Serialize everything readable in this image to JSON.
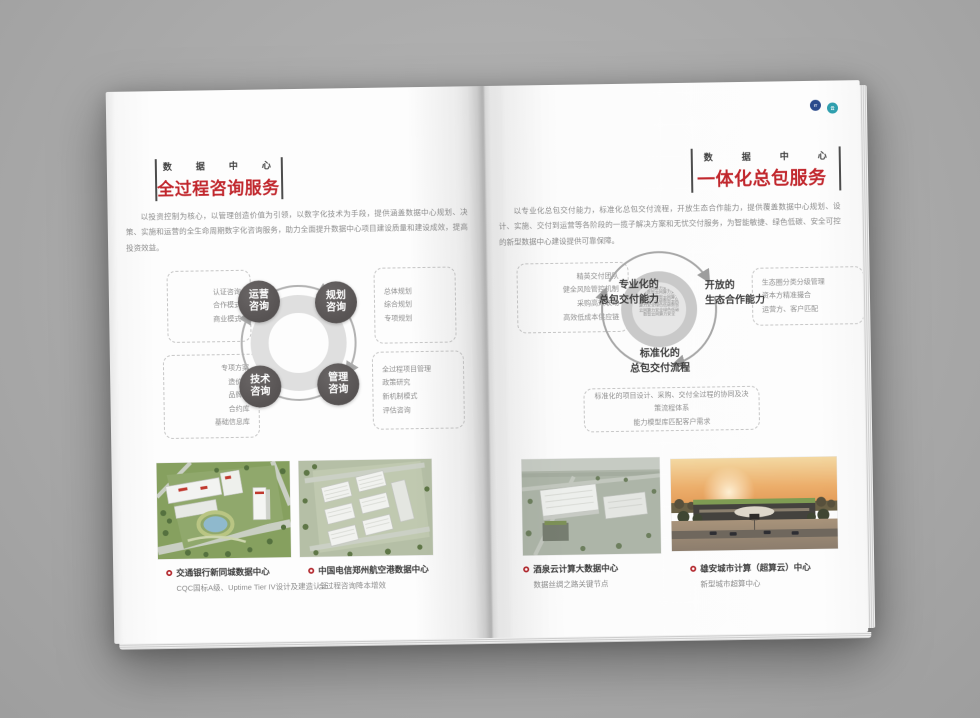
{
  "left_page": {
    "eyebrow": "数据中心",
    "title": "全过程咨询服务",
    "intro": "以投资控制为核心，以管理创造价值为引领，以数字化技术为手段，提供涵盖数据中心规划、决策、实施和运营的全生命周期数字化咨询服务，助力全面提升数据中心项目建设质量和建设成效，提高投资效益。",
    "diagram": {
      "nodes": [
        {
          "line1": "运营",
          "line2": "咨询"
        },
        {
          "line1": "规划",
          "line2": "咨询"
        },
        {
          "line1": "技术",
          "line2": "咨询"
        },
        {
          "line1": "管理",
          "line2": "咨询"
        }
      ],
      "boxes": {
        "top_left": [
          "认证咨询",
          "合作模式",
          "商业模式"
        ],
        "top_right": [
          "总体规划",
          "综合规划",
          "专项规划"
        ],
        "bottom_left": [
          "专项方案",
          "造价库",
          "品牌库",
          "合约库",
          "基础信息库"
        ],
        "bottom_right": [
          "全过程项目管理",
          "政策研究",
          "新机制模式",
          "评估咨询"
        ]
      }
    },
    "cases": [
      {
        "title": "交通银行新同城数据中心",
        "subtitle": "CQC国标A级、Uptime Tier IV设计及建造认证"
      },
      {
        "title": "中国电信郑州航空港数据中心",
        "subtitle": "全过程咨询降本增效"
      }
    ]
  },
  "right_page": {
    "eyebrow": "数据中心",
    "title": "一体化总包服务",
    "intro": "以专业化总包交付能力，标准化总包交付流程，开放生态合作能力，提供覆盖数据中心规划、设计、实施、交付到运营等各阶段的一揽子解决方案和无忧交付服务，为智能敏捷、绿色低碳、安全可控的新型数据中心建设提供可靠保障。",
    "diagram": {
      "labels": {
        "professional": {
          "line1": "专业化的",
          "line2": "总包交付能力"
        },
        "open": {
          "line1": "开放的",
          "line2": "生态合作能力"
        },
        "standard": {
          "line1": "标准化的",
          "line2": "总包交付流程"
        }
      },
      "boxes": {
        "left": [
          "精英交付团队",
          "健全风险管控机制",
          "采购高效联动",
          "高效低成本供应链"
        ],
        "right": [
          "生态圈分类分级管理",
          "资本方精准撮合",
          "运营方、客户匹配"
        ],
        "bottom": [
          "标准化的项目设计、采购、交付全过程的协同及决策流程体系",
          "能力模型库匹配客户需求"
        ]
      },
      "graphic_chars": "数智云网算力安全绿色低碳数智云网算力安全绿色低碳数智云网算力安全绿色低碳数智云网算力安全绿色低碳数智云网算力安全绿色低碳数智云网算力安全"
    },
    "cases": [
      {
        "title": "酒泉云计算大数据中心",
        "subtitle": "数据丝绸之路关键节点"
      },
      {
        "title": "雄安城市计算（超算云）中心",
        "subtitle": "新型城市超算中心"
      }
    ]
  },
  "accent_color": "#c1272d"
}
